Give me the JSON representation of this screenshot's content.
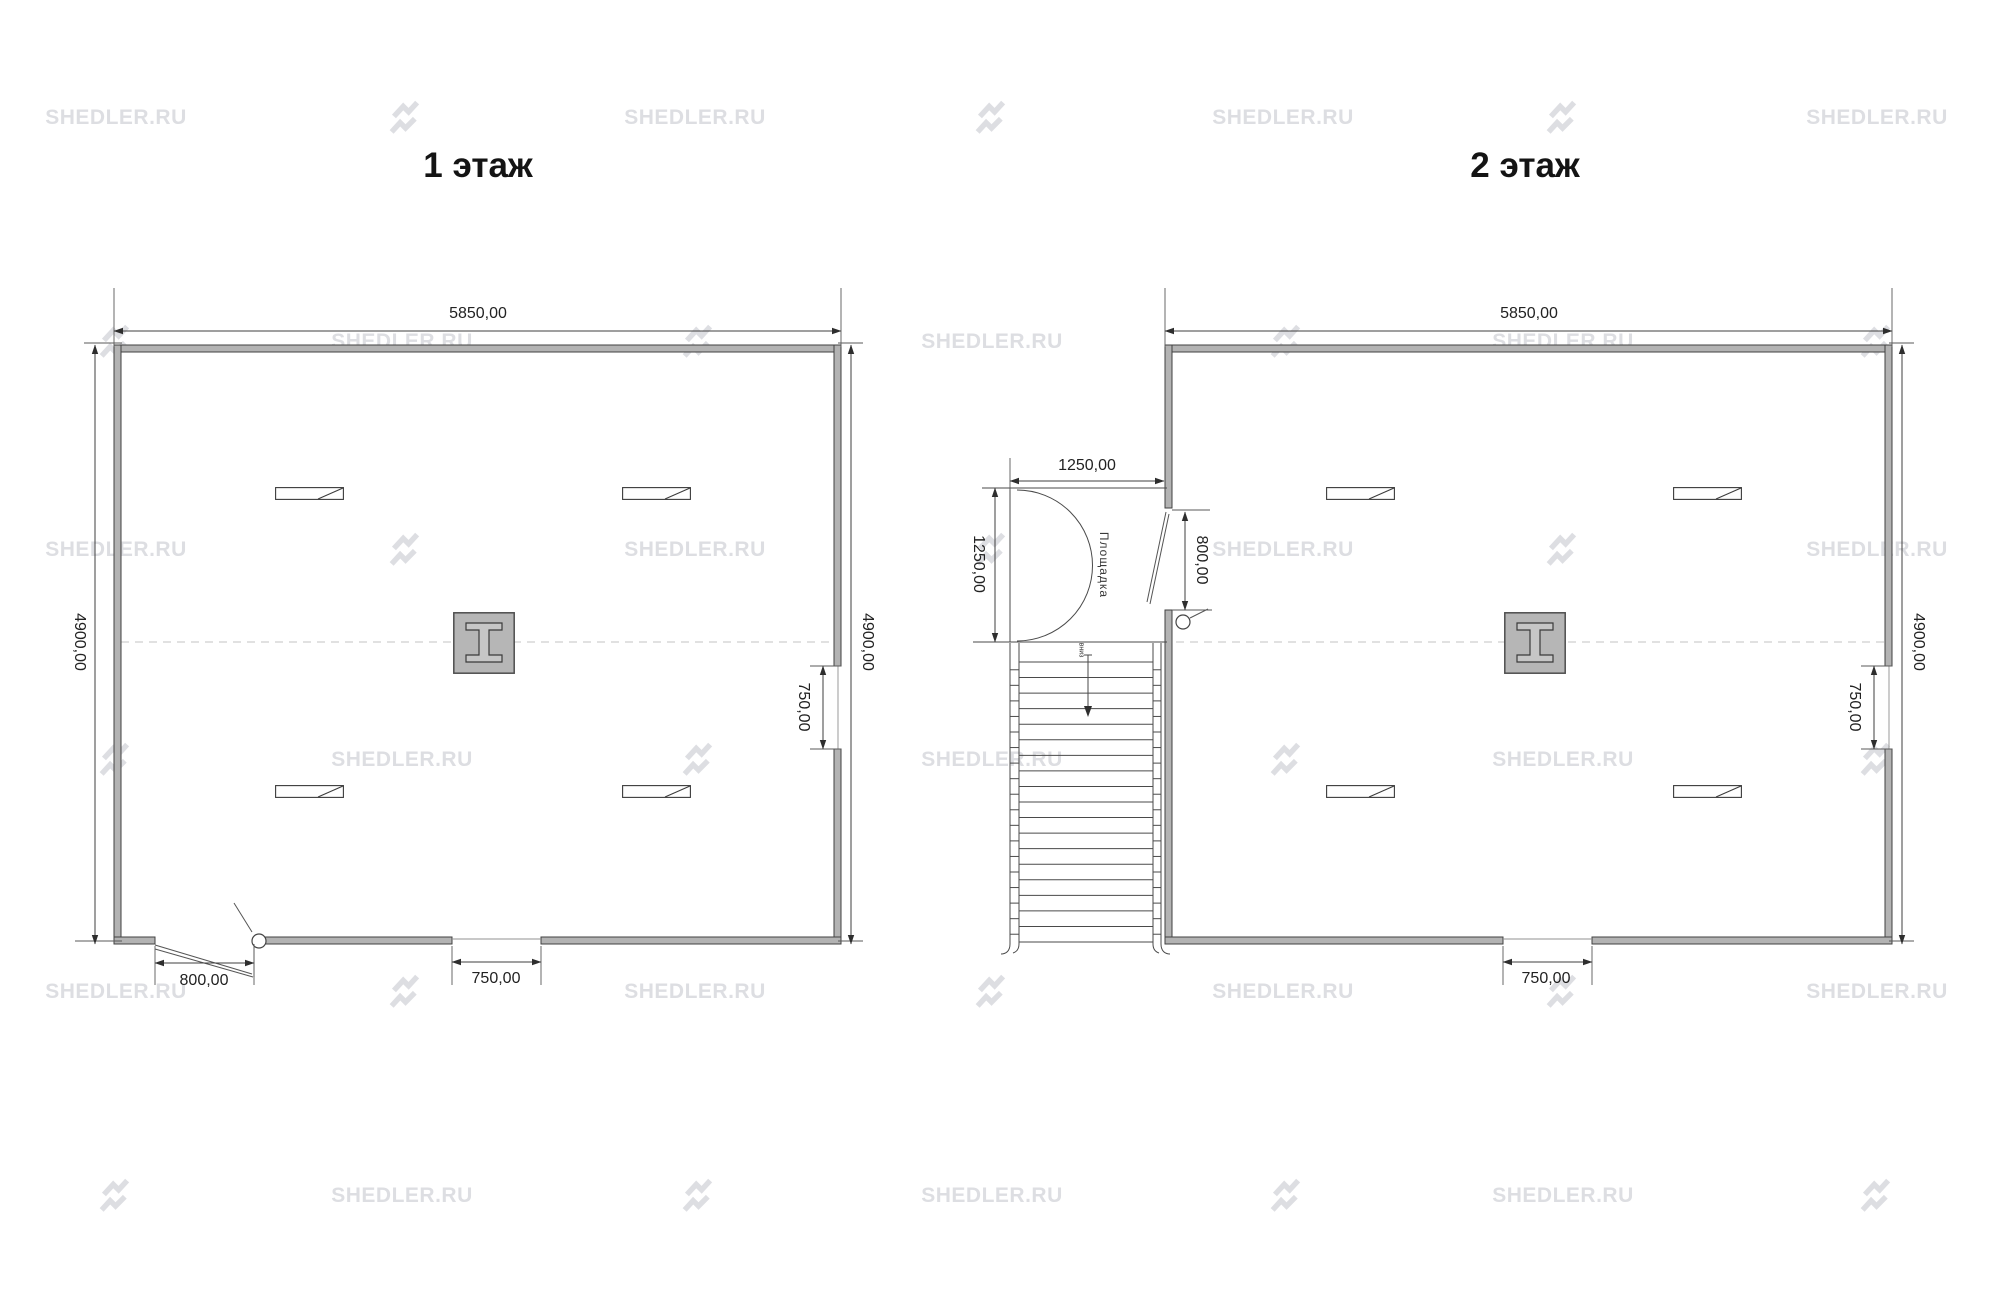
{
  "watermark": {
    "text": "SHEDLER.RU"
  },
  "plan1": {
    "title": "1 этаж",
    "dim_top": "5850,00",
    "dim_left": "4900,00",
    "dim_right": "4900,00",
    "dim_right_opening": "750,00",
    "dim_bottom_opening": "750,00",
    "dim_door": "800,00"
  },
  "plan2": {
    "title": "2 этаж",
    "dim_top": "5850,00",
    "dim_right": "4900,00",
    "dim_right_opening": "750,00",
    "dim_bottom_opening": "750,00",
    "dim_door": "800,00",
    "dim_landing_width": "1250,00",
    "dim_landing_depth": "1250,00",
    "landing_label": "Площадка",
    "stair_label": "вниз"
  }
}
